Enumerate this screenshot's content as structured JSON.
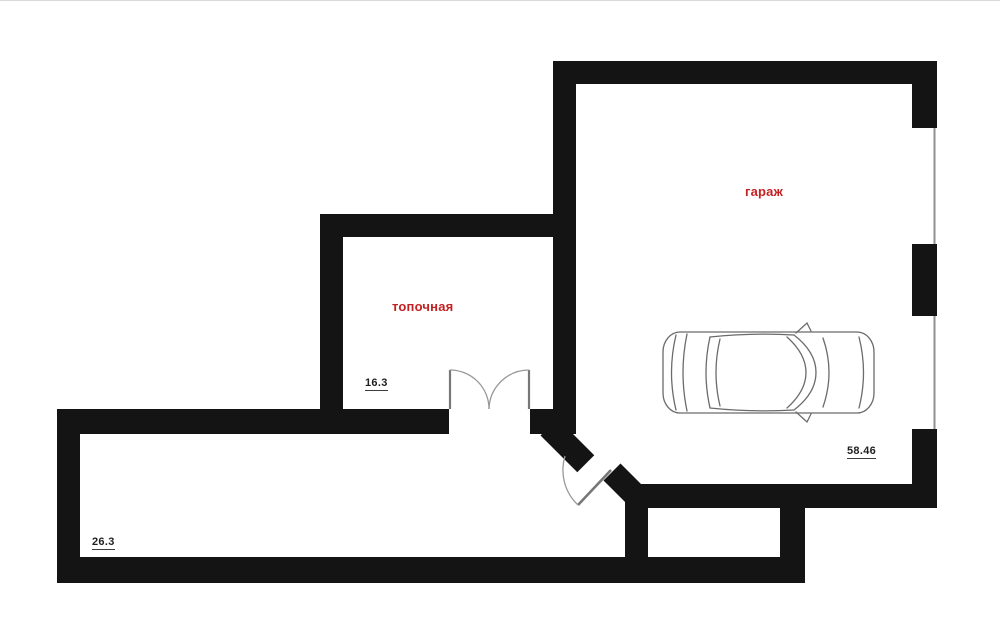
{
  "colors": {
    "wall": "#141414",
    "background": "#ffffff",
    "room_label": "#c32222",
    "dimension_text": "#1f1f1f",
    "door_line": "#8a8a8a",
    "window_line": "#8f8f8f",
    "car_outline": "#6b6b6b"
  },
  "rooms": {
    "garage": {
      "label": "гараж",
      "area": "58.46"
    },
    "boiler_room": {
      "label": "топочная",
      "area": "16.3"
    },
    "corridor": {
      "area": "26.3"
    }
  }
}
